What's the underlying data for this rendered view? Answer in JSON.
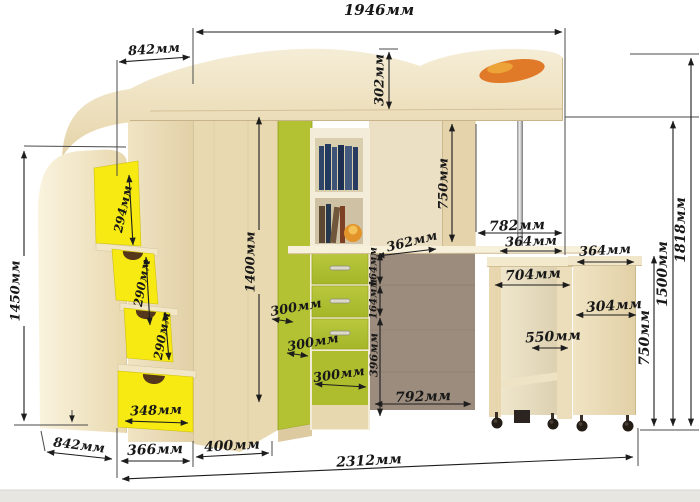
{
  "diagram": {
    "type": "furniture-dimension-drawing",
    "subject": "loft bed with stair drawers, corner wardrobe, shelves and pull-out desk",
    "unit": "мм"
  },
  "dims": {
    "bed_length_top": "1946мм",
    "bed_overhang_left": "842мм",
    "headboard_rail_height": "302мм",
    "stair_unit_height": "1450мм",
    "step_1": "294мм",
    "step_2": "290мм",
    "step_3": "290мм",
    "stair_drawer_width": "348мм",
    "stair_unit_depth": "842мм",
    "stair_unit_width": "366мм",
    "wardrobe_width": "400мм",
    "total_length": "2312мм",
    "wardrobe_door_height": "1400мм",
    "shelf_depth_upper": "300мм",
    "shelf_depth_lower": "300мм",
    "drawer_width": "300мм",
    "drawer_height_1": "164мм",
    "drawer_height_2": "164мм",
    "lower_panel_height": "396мм",
    "desktop_depth": "362мм",
    "underbed_clearance": "750мм",
    "niche_width": "792мм",
    "desk_bay_width": "782мм",
    "desk_bay_half": "364мм",
    "pullout_desk_width": "704мм",
    "pullout_desk_inner": "550мм",
    "cabinet_top_width": "364мм",
    "cabinet_depth": "304мм",
    "cabinet_height": "750мм",
    "bed_platform_height": "1500мм",
    "overall_height": "1818мм"
  },
  "colors": {
    "wood_light": "#f2e7c9",
    "wood_mid": "#e6d5ae",
    "accent_green": "#b2c232",
    "accent_yellow": "#f6ea12",
    "back_panel_taupe": "#9c8c7d",
    "decor_orange": "#e07a28",
    "dimension_line": "#1d1d1d"
  }
}
